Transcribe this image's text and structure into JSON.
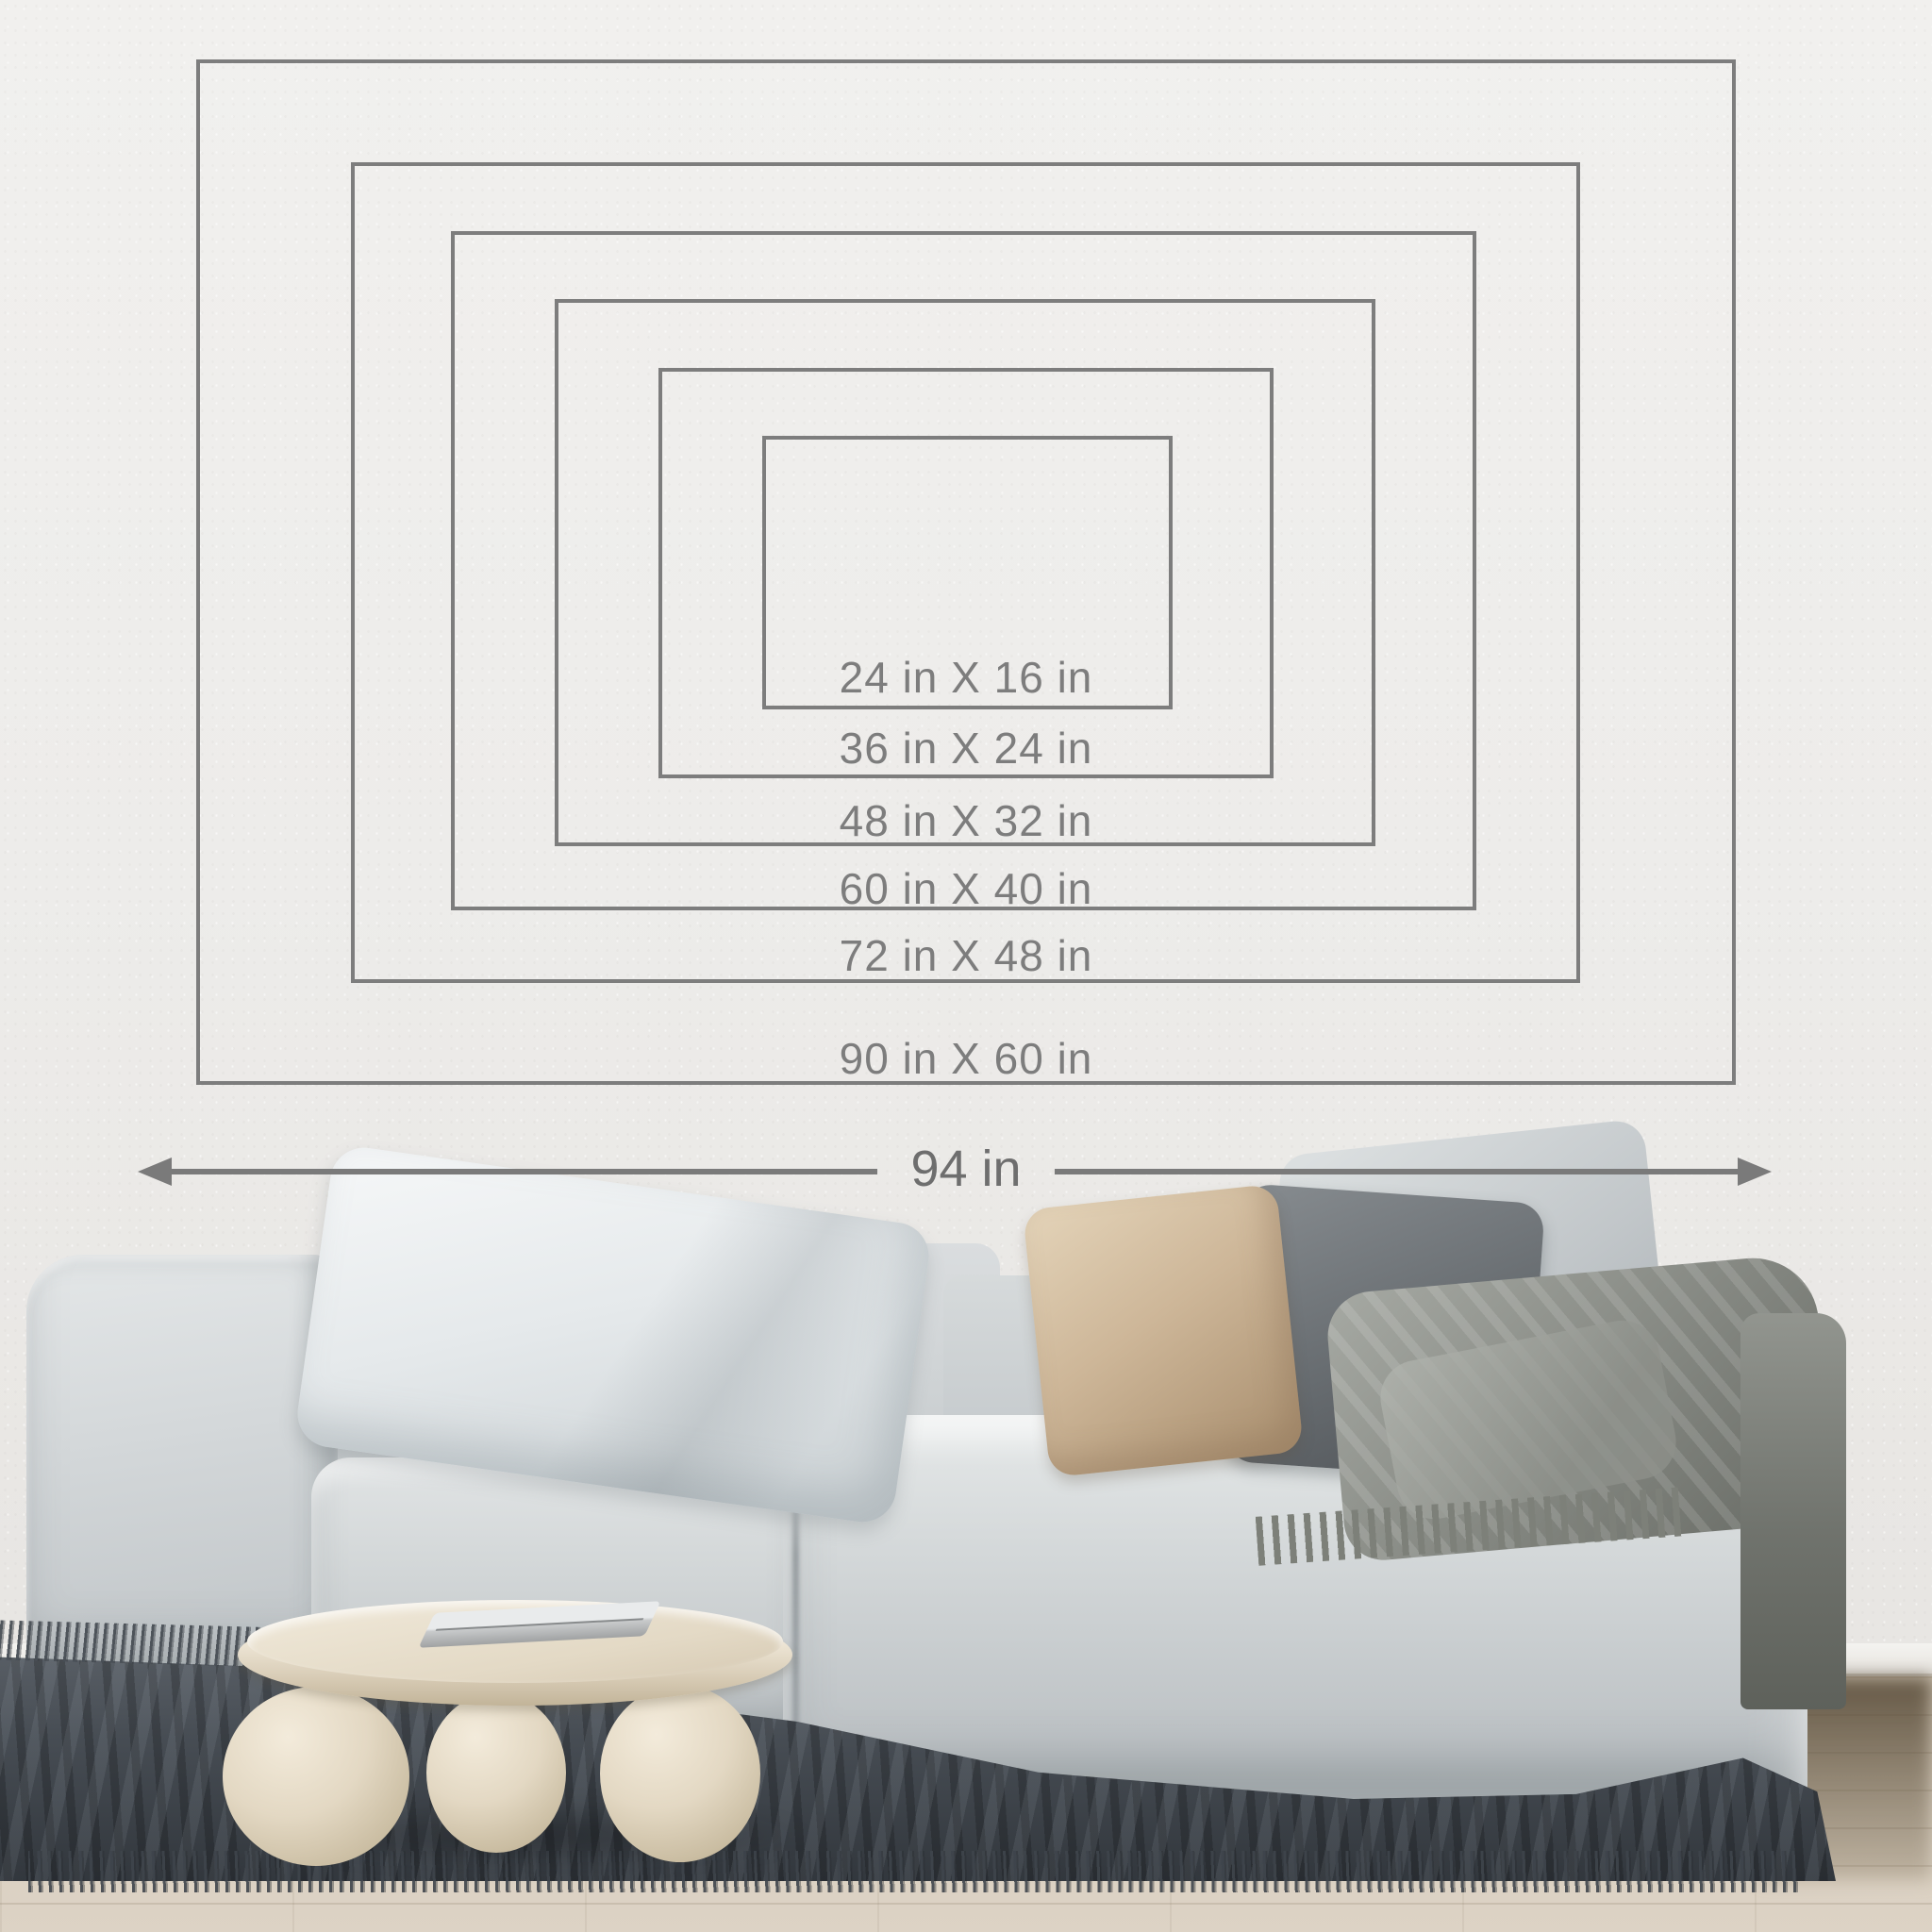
{
  "diagram": {
    "sizes": [
      {
        "label": "24 in X 16 in",
        "width_in": 24,
        "height_in": 16
      },
      {
        "label": "36 in X 24 in",
        "width_in": 36,
        "height_in": 24
      },
      {
        "label": "48 in X 32 in",
        "width_in": 48,
        "height_in": 32
      },
      {
        "label": "60 in X 40 in",
        "width_in": 60,
        "height_in": 40
      },
      {
        "label": "72 in X 48 in",
        "width_in": 72,
        "height_in": 48
      },
      {
        "label": "90 in X 60 in",
        "width_in": 90,
        "height_in": 60
      }
    ],
    "overall_width_label": "94 in",
    "overall_width_in": 94,
    "colors": {
      "outline": "#737373",
      "label_text": "#7d7d7d",
      "arrow": "#7a7a7a"
    }
  },
  "scene": {
    "colors": {
      "wall": "#edecea",
      "floor_wood": "#d7cdbe",
      "rug": "#42474d",
      "sofa_fabric": "#d5d9da",
      "pillow_white": "#eef1f2",
      "pillow_beige": "#cdb698",
      "pillow_dark_gray": "#6b7074",
      "pillow_light_gray": "#c3c8ca",
      "blanket": "#8c8f89",
      "coffee_table": "#e6ddca"
    }
  }
}
